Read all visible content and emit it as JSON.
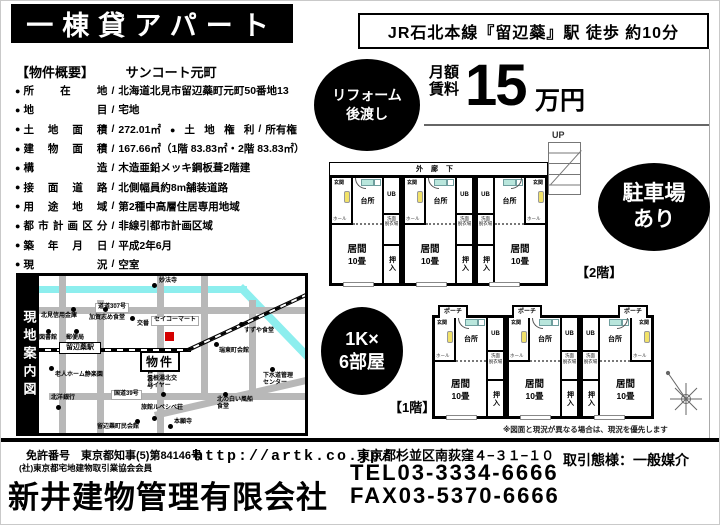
{
  "header": {
    "title": "一棟貸アパート",
    "station_info": "JR石北本線『留辺蘂』駅 徒歩 約10分"
  },
  "overview": {
    "section_label": "【物件概要】",
    "property_name": "サンコート元町",
    "items": [
      {
        "label": "所在地",
        "value": "北海道北見市留辺蘂町元町50番地13"
      },
      {
        "label": "地目",
        "value": "宅地"
      },
      {
        "label": "土地面積",
        "value": "272.01㎡",
        "label2": "土地権利",
        "value2": "所有権"
      },
      {
        "label": "建物面積",
        "value": "167.66㎡（1階 83.83㎡・2階 83.83㎡）"
      },
      {
        "label": "構造",
        "value": "木造亜鉛メッキ鋼板葺2階建"
      },
      {
        "label": "接面道路",
        "value": "北側幅員約8m舗装道路"
      },
      {
        "label": "用途地域",
        "value": "第2種中高層住居専用地域"
      },
      {
        "label": "都市計画区分",
        "value": "非線引都市計画区域"
      },
      {
        "label": "築年月日",
        "value": "平成2年6月"
      },
      {
        "label": "現況",
        "value": "空室"
      }
    ]
  },
  "badges": {
    "reform_line1": "リフォーム",
    "reform_line2": "後渡し",
    "parking_line1": "駐車場",
    "parking_line2": "あり",
    "rooms_line1": "1K×",
    "rooms_line2": "6部屋"
  },
  "rent": {
    "label_line1": "月額",
    "label_line2": "賃料",
    "amount": "15",
    "unit": "万円"
  },
  "floorplans": {
    "up_label": "UP",
    "corridor_label": "外廊下",
    "porch_label": "ポーチ",
    "floor2_label": "【2階】",
    "floor1_label": "【1階】",
    "disclaimer": "※図面と現況が異なる場合は、現況を優先します",
    "room_labels": {
      "entrance": "玄関",
      "hall": "ホール",
      "kitchen": "台所",
      "ub": "UB",
      "wash": "洗面\n脱衣場",
      "living": "居間",
      "living_size": "10畳",
      "closet": "押入"
    },
    "floor2_units": 3,
    "floor1_units": 3
  },
  "map": {
    "side_label": "現地案内図",
    "property_label": "物件",
    "station_label": "留辺蘂駅",
    "accent_marker_color": "#d40000",
    "river_color": "#8deeee",
    "pois": [
      {
        "t": "妙法寺",
        "lx": 120,
        "ly": 2,
        "dx": 113,
        "dy": 7
      },
      {
        "t": "道道307号",
        "lx": 56,
        "ly": 27,
        "box": true
      },
      {
        "t": "北見信用金庫",
        "lx": 2,
        "ly": 37,
        "dx": 32,
        "dy": 31
      },
      {
        "t": "加賀志め食堂",
        "lx": 50,
        "ly": 39,
        "dx": 64,
        "dy": 31
      },
      {
        "t": "交番",
        "lx": 98,
        "ly": 45,
        "dx": 91,
        "dy": 40
      },
      {
        "t": "セイコーマート",
        "lx": 112,
        "ly": 40,
        "box": true
      },
      {
        "t": "図書館",
        "lx": 0,
        "ly": 59,
        "dx": 7,
        "dy": 53
      },
      {
        "t": "郵便局",
        "lx": 27,
        "ly": 59,
        "dx": 35,
        "dy": 53
      },
      {
        "t": "すずや食堂",
        "lx": 205,
        "ly": 52,
        "dx": 200,
        "dy": 46
      },
      {
        "t": "瑞東町会館",
        "lx": 180,
        "ly": 72,
        "dx": 175,
        "dy": 66
      },
      {
        "t": "道道103号",
        "lx": 106,
        "ly": 82,
        "vert": true
      },
      {
        "t": "老人ホーム静楽園",
        "lx": 16,
        "ly": 96,
        "dx": 10,
        "dy": 90
      },
      {
        "t": "下水道管理\nセンター",
        "lx": 224,
        "ly": 97,
        "dx": 231,
        "dy": 91
      },
      {
        "t": "温根湯北交\nハイヤー",
        "lx": 108,
        "ly": 100,
        "dx": 122,
        "dy": 116
      },
      {
        "t": "国道39号",
        "lx": 72,
        "ly": 114,
        "box": true
      },
      {
        "t": "北洋銀行",
        "lx": 12,
        "ly": 119,
        "dx": 17,
        "dy": 129
      },
      {
        "t": "北の白い風船\n食堂",
        "lx": 178,
        "ly": 121,
        "dx": 184,
        "dy": 116
      },
      {
        "t": "旅館ルベシベ荘",
        "lx": 102,
        "ly": 129,
        "dx": 113,
        "dy": 140
      },
      {
        "t": "本願寺",
        "lx": 135,
        "ly": 143,
        "dx": 129,
        "dy": 148
      },
      {
        "t": "留辺蘂町民会館",
        "lx": 58,
        "ly": 148,
        "dx": 96,
        "dy": 143
      }
    ]
  },
  "footer": {
    "license_line1": "免許番号　東京都知事(5)第84146号",
    "license_line2": "(社)東京都宅地建物取引業協会会員",
    "company": "新井建物管理有限会社",
    "url": "http://artk.co.jp/",
    "address": "東京都杉並区南荻窪４−３１−１０",
    "tel": "TEL03-3334-6666",
    "fax": "FAX03-5370-6666",
    "deal_type": "取引態様：一般媒介"
  }
}
